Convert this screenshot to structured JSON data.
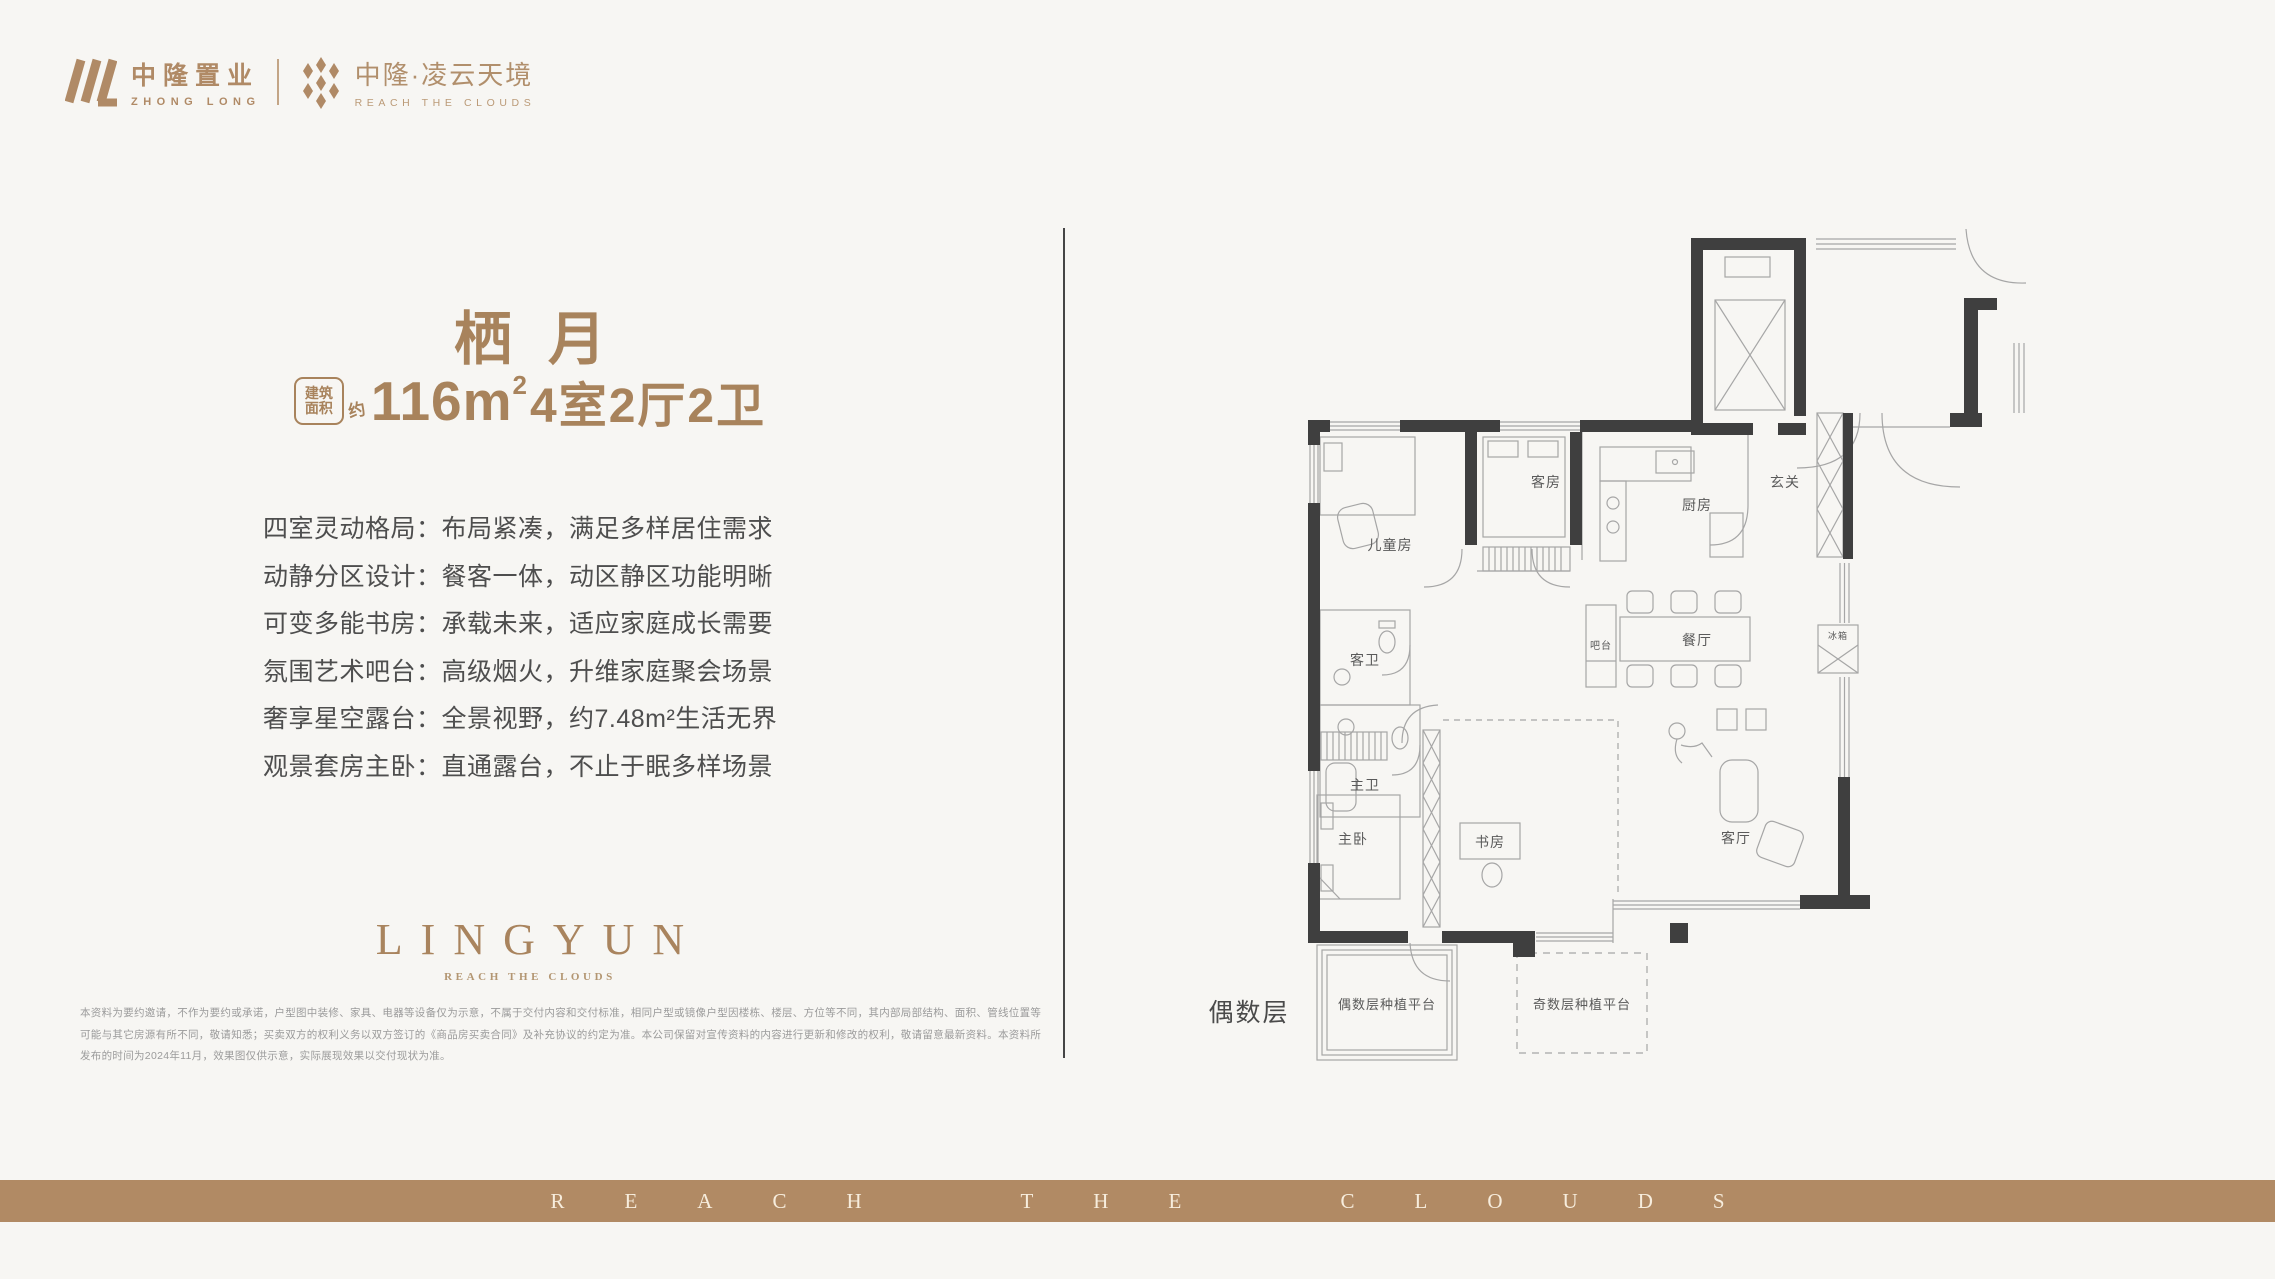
{
  "page": {
    "background": "#f7f6f3",
    "accent": "#b08a66",
    "wall_color": "#3f3f3f",
    "line_color": "#a6a6a6"
  },
  "header": {
    "brand_cn": "中隆置业",
    "brand_en": "ZHONG LONG",
    "project_cn": "中隆·凌云天境",
    "project_en": "REACH THE CLOUDS"
  },
  "unit": {
    "name": "栖月",
    "badge_line1": "建筑",
    "badge_line2": "面积",
    "badge_approx": "约",
    "area_number": "116m",
    "area_sup": "2",
    "layout_suffix": "4室2厅2卫"
  },
  "features": [
    "四室灵动格局：布局紧凑，满足多样居住需求",
    "动静分区设计：餐客一体，动区静区功能明晰",
    "可变多能书房：承载未来，适应家庭成长需要",
    "氛围艺术吧台：高级烟火，升维家庭聚会场景",
    "奢享星空露台：全景视野，约7.48m²生活无界",
    "观景套房主卧：直通露台，不止于眠多样场景"
  ],
  "logo_block": {
    "wordmark": "LINGYUN",
    "tagline": "REACH THE CLOUDS"
  },
  "disclaimer": [
    "本资料为要约邀请，不作为要约或承诺，户型图中装修、家具、电器等设备仅为示意，不属于交付内容和交付标准，相同户型或镜像户型因楼栋、楼层、方位等不同，其内部局部结构、面积、管线位置等",
    "可能与其它房源有所不同，敬请知悉；买卖双方的权利义务以双方签订的《商品房买卖合同》及补充协议的约定为准。本公司保留对宣传资料的内容进行更新和修改的权利，敬请留意最新资料。本资料所",
    "发布的时间为2024年11月，效果图仅供示意，实际展现效果以交付现状为准。"
  ],
  "floorplan": {
    "rooms": [
      {
        "label": "儿童房"
      },
      {
        "label": "客房"
      },
      {
        "label": "客卫"
      },
      {
        "label": "主卫"
      },
      {
        "label": "厨房"
      },
      {
        "label": "玄关"
      },
      {
        "label": "餐厅"
      },
      {
        "label": "吧台"
      },
      {
        "label": "冰箱"
      },
      {
        "label": "主卧"
      },
      {
        "label": "书房"
      },
      {
        "label": "客厅"
      },
      {
        "label": "偶数层种植平台"
      },
      {
        "label": "奇数层种植平台"
      }
    ],
    "floor_note": "偶数层"
  },
  "footer": {
    "banner_text": "REACH THE CLOUDS"
  }
}
